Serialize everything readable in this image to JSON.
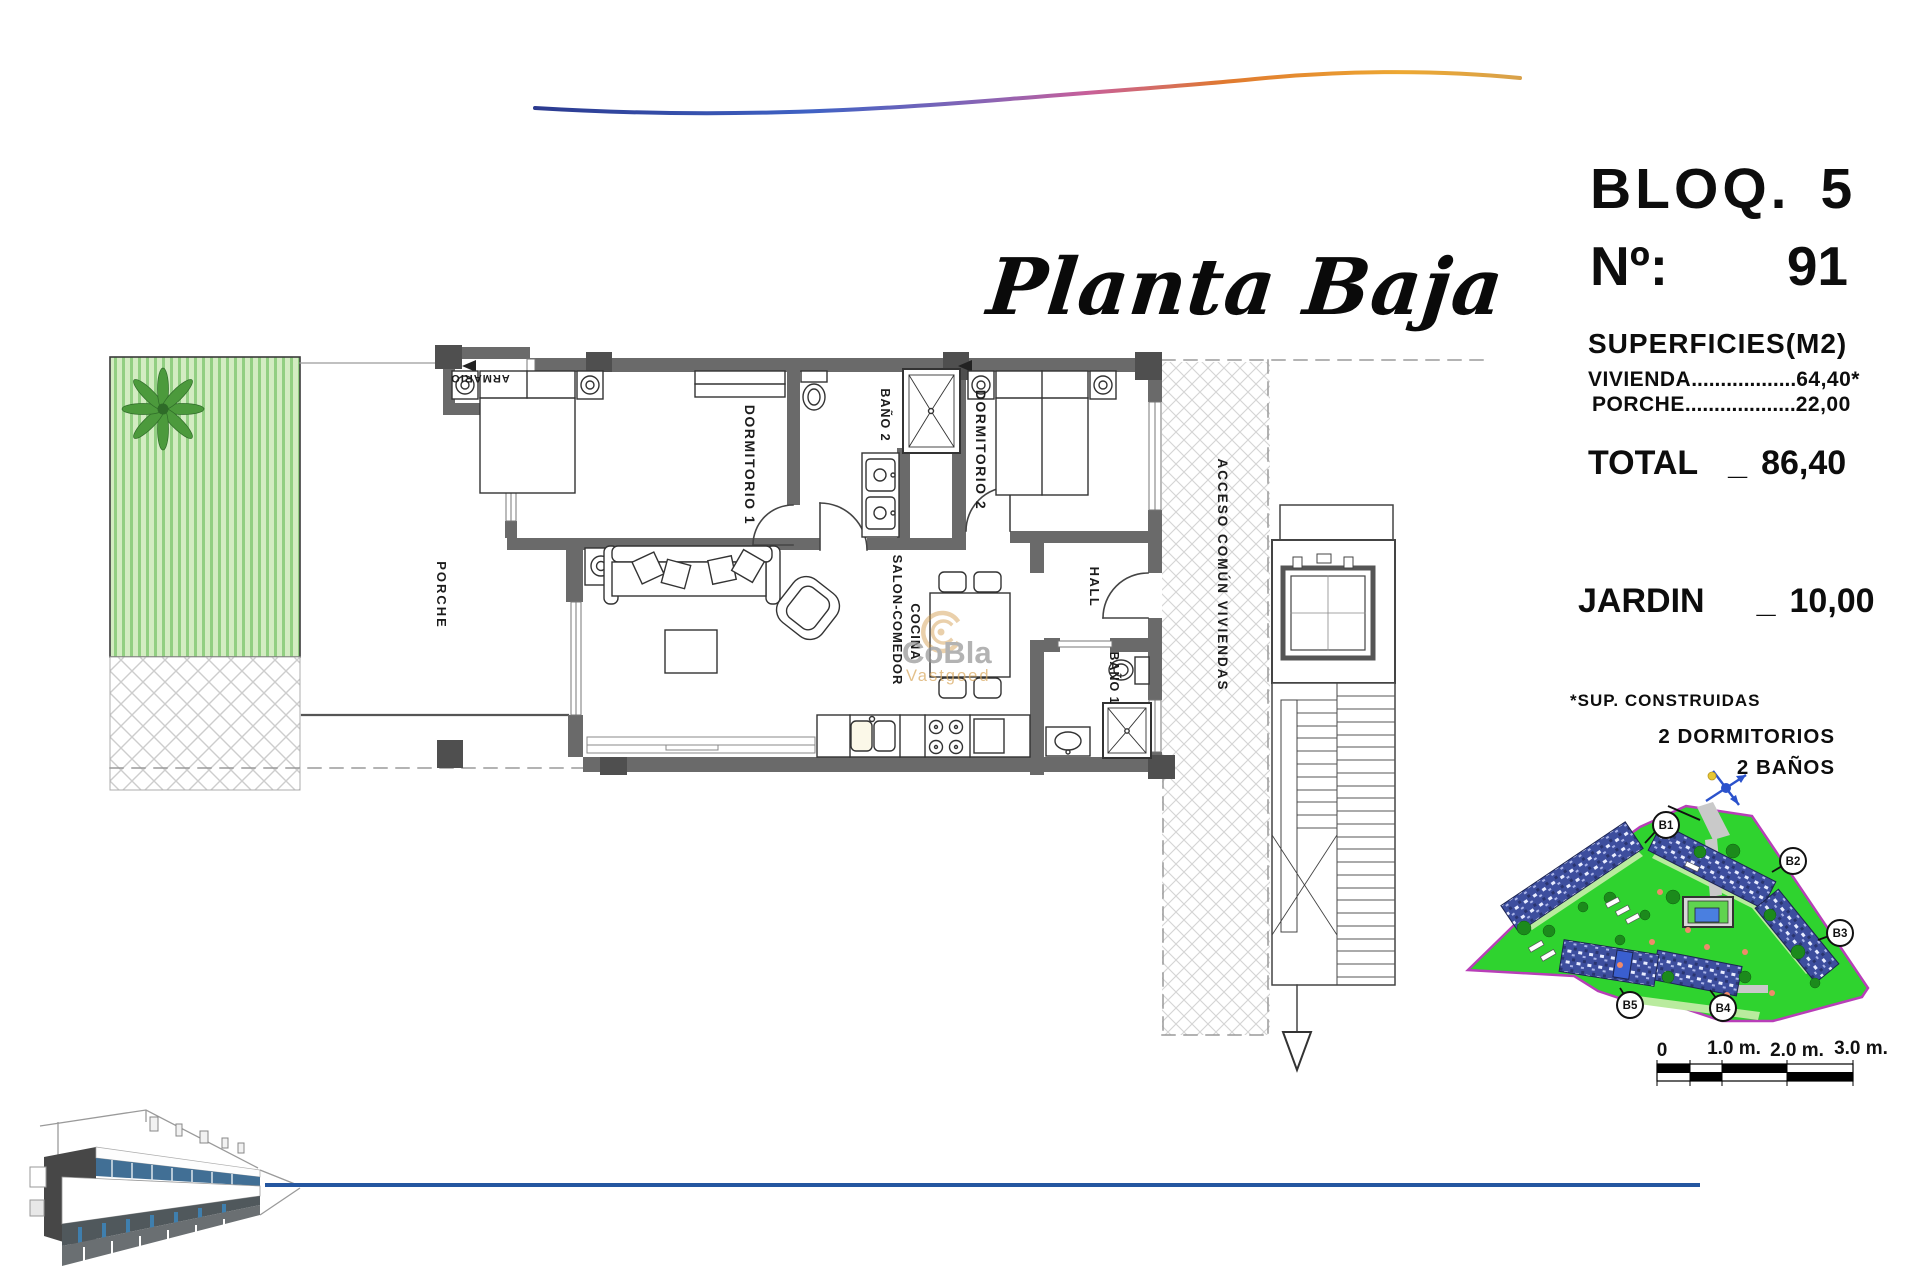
{
  "title": {
    "text": "Planta Baja"
  },
  "info_panel": {
    "block": {
      "label": "BLOQ.",
      "value": "5"
    },
    "number": {
      "label": "Nº:",
      "value": "91"
    },
    "surfaces": {
      "heading": "SUPERFICIES(M2)",
      "rows": [
        {
          "label": "VIVIENDA",
          "dots": "..................",
          "value": "64,40*"
        },
        {
          "label": "PORCHE",
          "dots": "...................",
          "value": "22,00"
        }
      ]
    },
    "total": {
      "label": "TOTAL",
      "separator": "_",
      "value": "86,40"
    },
    "jardin": {
      "label": "JARDIN",
      "separator": "_",
      "value": "10,00"
    },
    "footnote": "*SUP. CONSTRUIDAS",
    "features": [
      "2 DORMITORIOS",
      "2 BAÑOS"
    ]
  },
  "plan": {
    "room_labels": {
      "armario": "ARMARIO",
      "dormitorio1": "DORMITORIO 1",
      "bano2": "BAÑO 2",
      "dormitorio2": "DORMITORIO 2",
      "hall": "HALL",
      "bano1": "BAÑO 1",
      "salon_line1": "SALON-COMEDOR",
      "salon_line2": "COCINA",
      "porche": "PORCHE",
      "acceso": "ACCESO COMÚN VIVIENDAS"
    }
  },
  "watermark": {
    "brand": "CoBla",
    "sub": "Vastgoed"
  },
  "site_plan": {
    "blocks": [
      "B1",
      "B2",
      "B3",
      "B4",
      "B5"
    ]
  },
  "scale_bar": {
    "labels": [
      "0",
      "1.0 m.",
      "2.0 m.",
      "3.0 m."
    ]
  },
  "colors": {
    "wall": "#6a6a6a",
    "site_green": "#2fd32f",
    "site_boundary": "#b83eb8",
    "blue_line": "#2456a0",
    "wave_start": "#2b3a8f",
    "wave_end": "#eda832",
    "watermark_orange": "#cf9440"
  }
}
